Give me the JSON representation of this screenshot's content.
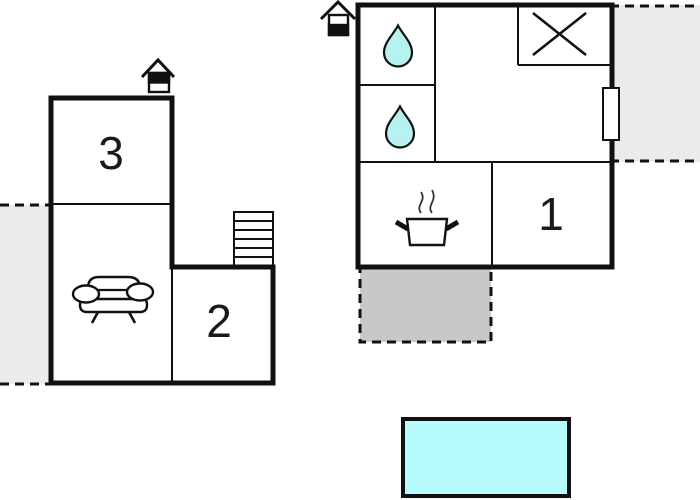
{
  "page": {
    "type": "floor-plan",
    "background": "#ffffff"
  },
  "colors": {
    "wall": "#111111",
    "room_fill": "#ffffff",
    "water_drop": "#b6f2f0",
    "pool": "#b7fcfd",
    "patio": "#ebebeb",
    "terrace": "#c8c8c8"
  },
  "rooms": {
    "room1_label": "1",
    "room2_label": "2",
    "room3_label": "3"
  },
  "icons": {
    "entrance_left": "house-entrance-icon",
    "entrance_right": "house-entrance-icon",
    "water_drop_top": "water-drop-icon",
    "water_drop_bottom": "water-drop-icon",
    "shower": "shower-cross-icon",
    "stove": "cooking-pot-steam-icon",
    "sofa": "sofa-icon",
    "stairs": "stairs-icon",
    "door": "door-opening",
    "pool": "swimming-pool",
    "terrace": "terrace-area",
    "patio": "patio-area"
  }
}
